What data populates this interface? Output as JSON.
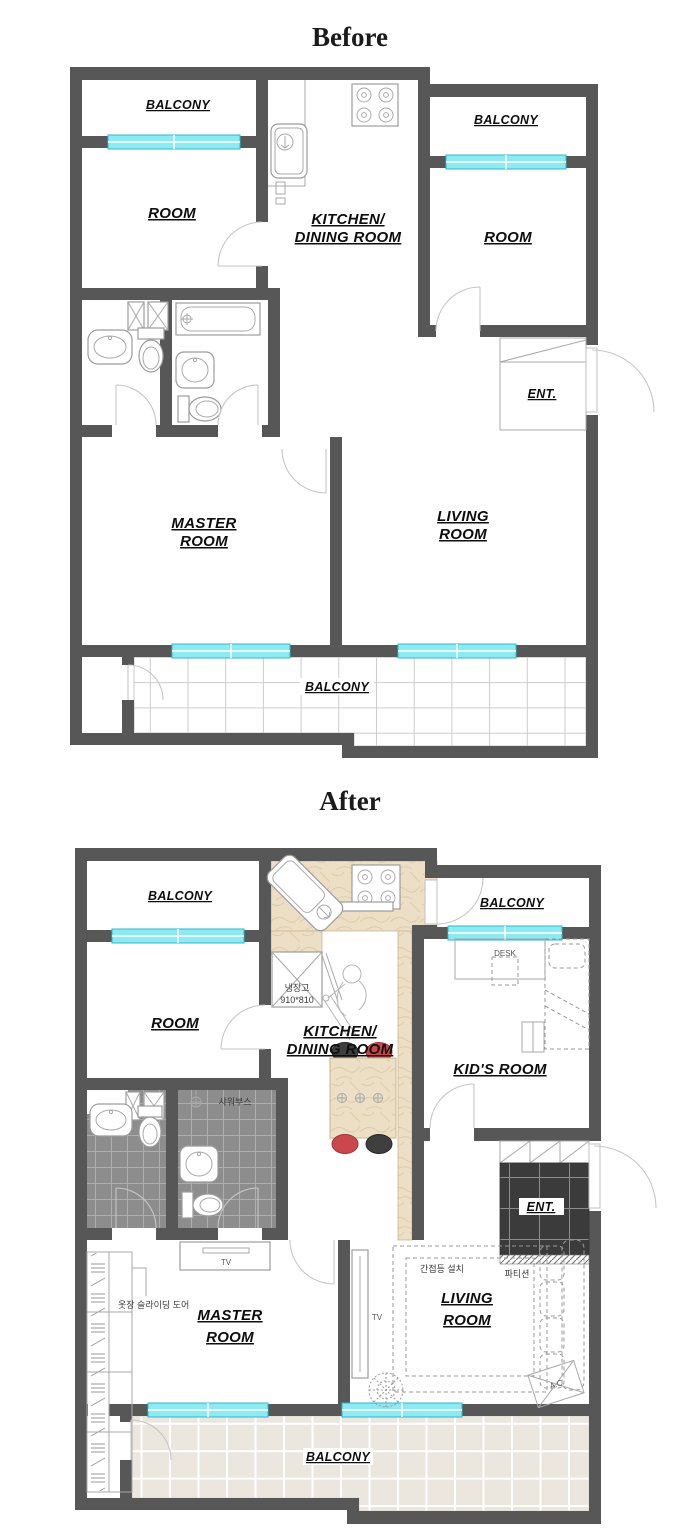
{
  "page": {
    "background": "#ffffff"
  },
  "colors": {
    "wall": "#575757",
    "window_fill": "#8de9f2",
    "window_edge": "#2fb9c9",
    "counter_marble": "#ecdfc6",
    "bath_tile": "#8d8d8d",
    "ent_tile": "#3b3b3b",
    "balcony_tile_after": "#ebe7df",
    "chair_red": "#c9484e",
    "chair_black": "#3f3f3f",
    "label_text": "#0e0e0e"
  },
  "before": {
    "title": "Before",
    "labels": {
      "balcony_top_left": "BALCONY",
      "room_left": "ROOM",
      "kitchen_line1": "KITCHEN/",
      "kitchen_line2": "DINING ROOM",
      "balcony_top_right": "BALCONY",
      "room_right": "ROOM",
      "entrance": "ENT.",
      "master_line1": "MASTER",
      "master_line2": "ROOM",
      "living_line1": "LIVING",
      "living_line2": "ROOM",
      "balcony_bottom": "BALCONY"
    }
  },
  "after": {
    "title": "After",
    "labels": {
      "balcony_top_left": "BALCONY",
      "room_left": "ROOM",
      "kitchen_line1": "KITCHEN/",
      "kitchen_line2": "DINING ROOM",
      "balcony_top_right": "BALCONY",
      "kids_room": "KID'S ROOM",
      "desk": "DESK",
      "entrance": "ENT.",
      "partition_ko": "파티션",
      "fridge_ko": "냉장고",
      "fridge_size": "910*810",
      "shower_ko": "샤워부스",
      "wardrobe_ko": "옷장 슬라이딩 도어",
      "indirect_light_ko": "간접등 설치",
      "master_line1": "MASTER",
      "master_line2": "ROOM",
      "living_line1": "LIVING",
      "living_line2": "ROOM",
      "tv_master": "TV",
      "tv_living": "TV",
      "ac_unit": "A.C",
      "balcony_bottom": "BALCONY"
    }
  }
}
